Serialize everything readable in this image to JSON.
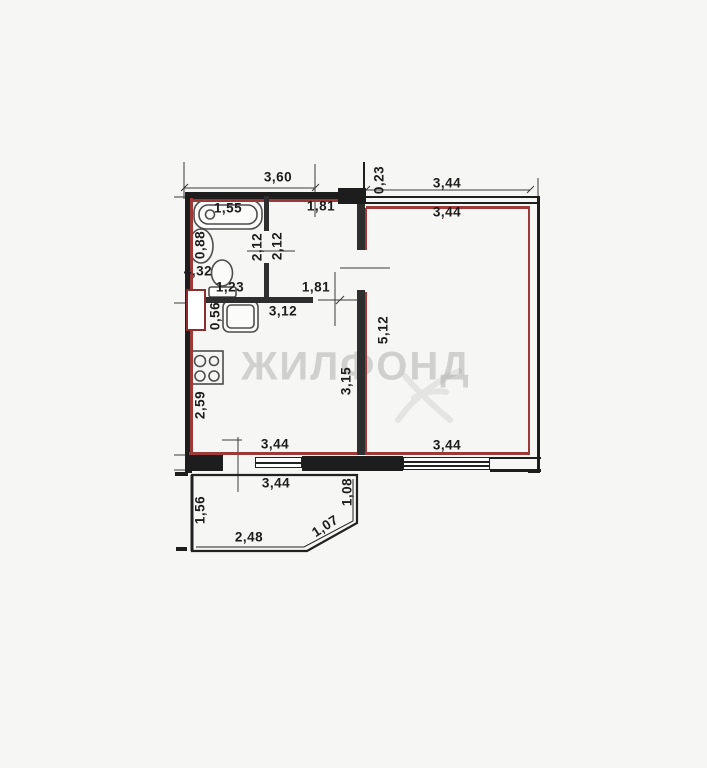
{
  "watermark": {
    "text": "ЖИЛФОНД"
  },
  "colors": {
    "unit_outline_red": "#9c3a3a",
    "wall_dark": "#1d1d1d",
    "dimension_text": "#1c1c1c",
    "watermark_gray": "#9a9a9a"
  },
  "plan": {
    "type": "apartment-floor-plan",
    "fixtures": [
      "bathtub",
      "sink",
      "toilet",
      "washing-machine",
      "stove-hob"
    ],
    "areas": [
      "bathroom",
      "hallway",
      "kitchen",
      "living-room",
      "balcony"
    ]
  },
  "dimensions": [
    {
      "label": "3,60",
      "x": 278,
      "y": 177,
      "rot": 0
    },
    {
      "label": "0,23",
      "x": 379,
      "y": 180,
      "rot": -90
    },
    {
      "label": "3,44",
      "x": 447,
      "y": 183,
      "rot": 0
    },
    {
      "label": "3,44",
      "x": 447,
      "y": 212,
      "rot": 0
    },
    {
      "label": "1,55",
      "x": 228,
      "y": 208,
      "rot": 0
    },
    {
      "label": "1,81",
      "x": 321,
      "y": 206,
      "rot": 0
    },
    {
      "label": "0,88",
      "x": 200,
      "y": 245,
      "rot": -90
    },
    {
      "label": "2,12",
      "x": 257,
      "y": 247,
      "rot": -90
    },
    {
      "label": "2,12",
      "x": 277,
      "y": 246,
      "rot": -90
    },
    {
      "label": "4,32",
      "x": 198,
      "y": 271,
      "rot": 0
    },
    {
      "label": "1,23",
      "x": 230,
      "y": 287,
      "rot": 0
    },
    {
      "label": "1,81",
      "x": 316,
      "y": 287,
      "rot": 0
    },
    {
      "label": "3,12",
      "x": 283,
      "y": 311,
      "rot": 0
    },
    {
      "label": "0,56",
      "x": 215,
      "y": 316,
      "rot": -90
    },
    {
      "label": "5,12",
      "x": 383,
      "y": 330,
      "rot": -90
    },
    {
      "label": "3,15",
      "x": 346,
      "y": 381,
      "rot": -90
    },
    {
      "label": "2,59",
      "x": 200,
      "y": 405,
      "rot": -90
    },
    {
      "label": "3,44",
      "x": 275,
      "y": 444,
      "rot": 0
    },
    {
      "label": "3,44",
      "x": 447,
      "y": 445,
      "rot": 0
    },
    {
      "label": "3,44",
      "x": 276,
      "y": 483,
      "rot": 0
    },
    {
      "label": "1,08",
      "x": 347,
      "y": 492,
      "rot": -90
    },
    {
      "label": "1,56",
      "x": 200,
      "y": 510,
      "rot": -90
    },
    {
      "label": "1,07",
      "x": 325,
      "y": 526,
      "rot": -33
    },
    {
      "label": "2,48",
      "x": 249,
      "y": 537,
      "rot": 0
    }
  ]
}
